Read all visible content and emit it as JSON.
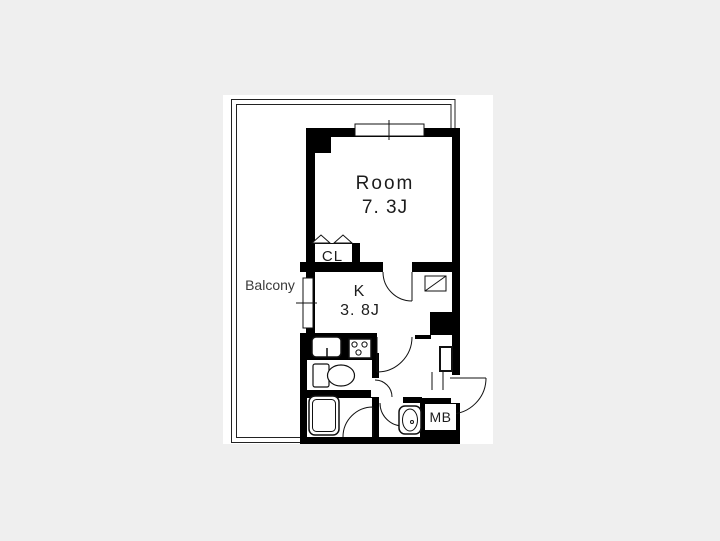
{
  "plan": {
    "room": {
      "name": "Room",
      "size": "7. 3J"
    },
    "kitchen": {
      "name": "K",
      "size": "3. 8J"
    },
    "closet": {
      "name": "CL"
    },
    "balcony": {
      "name": "Balcony"
    },
    "meter_box": {
      "name": "MB"
    },
    "colors": {
      "page_bg": "#efefef",
      "sheet": "#ffffff",
      "wall": "#000000",
      "line": "#111111",
      "text": "#1c1c1c"
    }
  }
}
